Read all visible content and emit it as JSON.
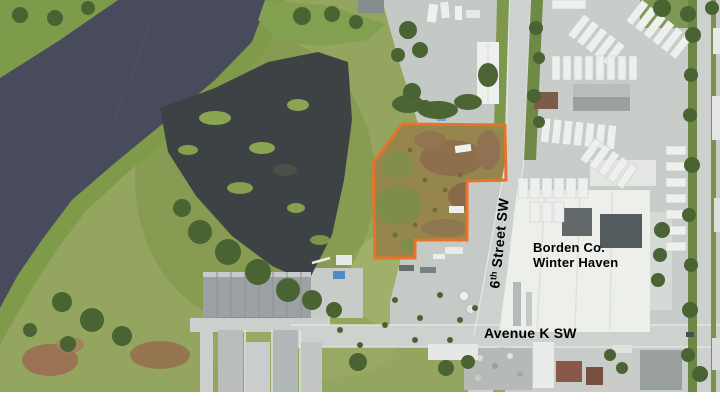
{
  "page": {
    "background": "#ffffff"
  },
  "map": {
    "parcel": {
      "outline_color": "#E8722A"
    },
    "colors": {
      "lake_water": "#474B5C",
      "pond_water": "#3D4344",
      "shore_green": "#7F9B4A",
      "label_text": "#000000"
    },
    "labels": {
      "street": {
        "number": "6",
        "ordinal": "th",
        "rest": " Street SW"
      },
      "plant_line1": "Borden Co.",
      "plant_line2": "Winter Haven",
      "avenue": "Avenue K SW"
    }
  }
}
